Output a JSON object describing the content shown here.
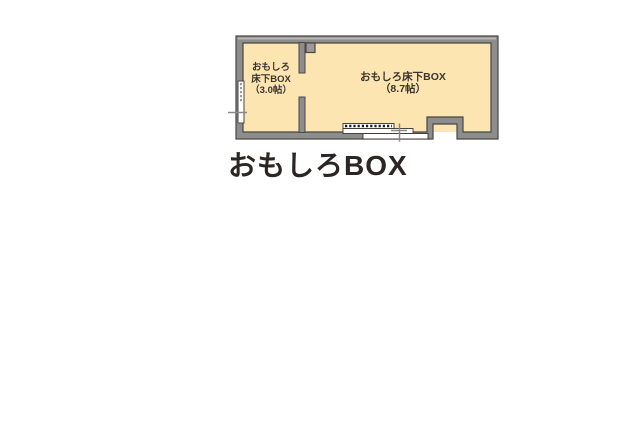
{
  "title": "おもしろBOX",
  "plan": {
    "room_small": {
      "lines": [
        "おもしろ",
        "床下BOX",
        "（3.0帖）"
      ],
      "name": "おもしろ床下BOX",
      "size": "3.0帖"
    },
    "room_large": {
      "lines": [
        "おもしろ床下BOX",
        "（8.7帖）"
      ],
      "name": "おもしろ床下BOX",
      "size": "8.7帖"
    }
  },
  "colors": {
    "room_fill": "#fce5b1",
    "wall_fill": "#8d8d8d",
    "wall_highlight": "#b9b9b9",
    "wall_outline": "#4a4743",
    "fixture_fill": "#ffffff",
    "tick_gray": "#8a8a8a",
    "label_text": "#3a3430",
    "title_text": "#2b2523"
  }
}
